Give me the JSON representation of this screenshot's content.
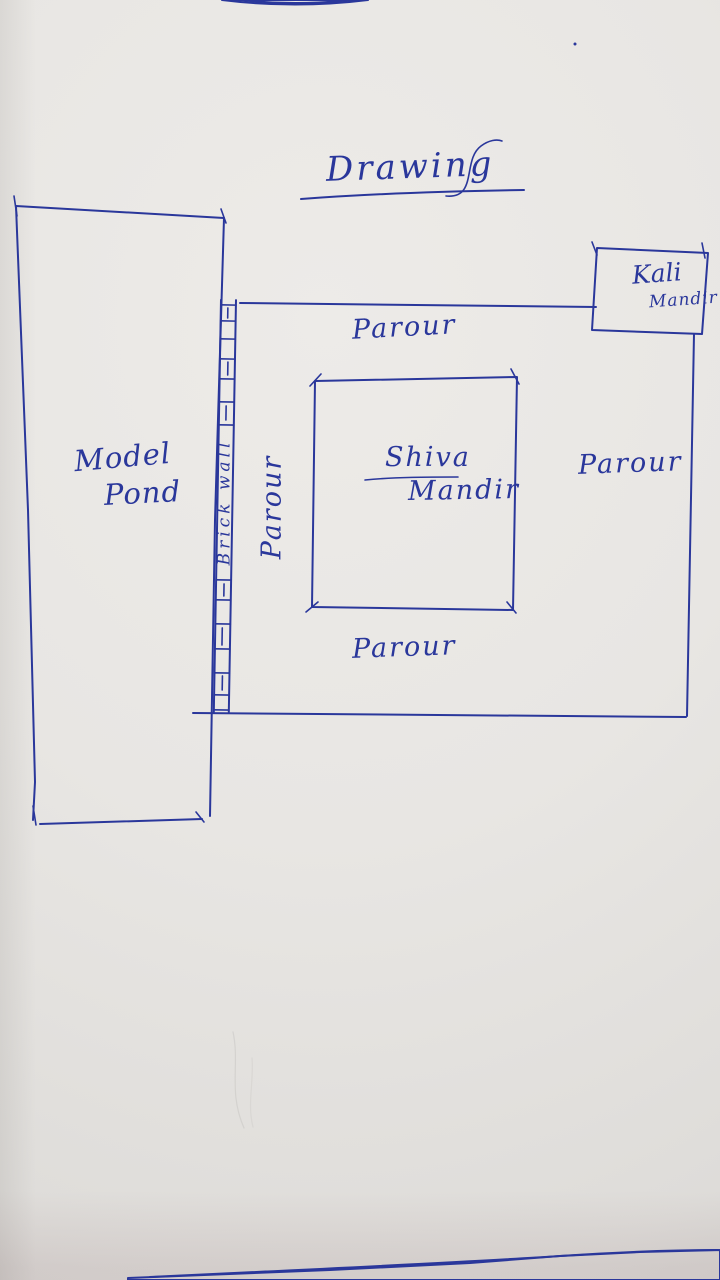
{
  "labels": {
    "title": "Drawing",
    "kali": {
      "line1": "Kali",
      "line2": "Mandir"
    },
    "shiva": {
      "line1": "Shiva",
      "line2": "Mandir"
    },
    "model_pond": {
      "line1": "Model",
      "line2": "Pond"
    },
    "brick_wall": "Brick wall",
    "corridor_top": "Parour",
    "corridor_bottom": "Parour",
    "corridor_left": "Parour",
    "corridor_right": "Parour"
  },
  "colors": {
    "ink": "#2a379b",
    "paper": "#e8e6e3",
    "table": "#7c2836",
    "table_highlight": "#d9a8bb",
    "sliver_outer": "#d791b3",
    "sliver_inner": "#943158"
  }
}
